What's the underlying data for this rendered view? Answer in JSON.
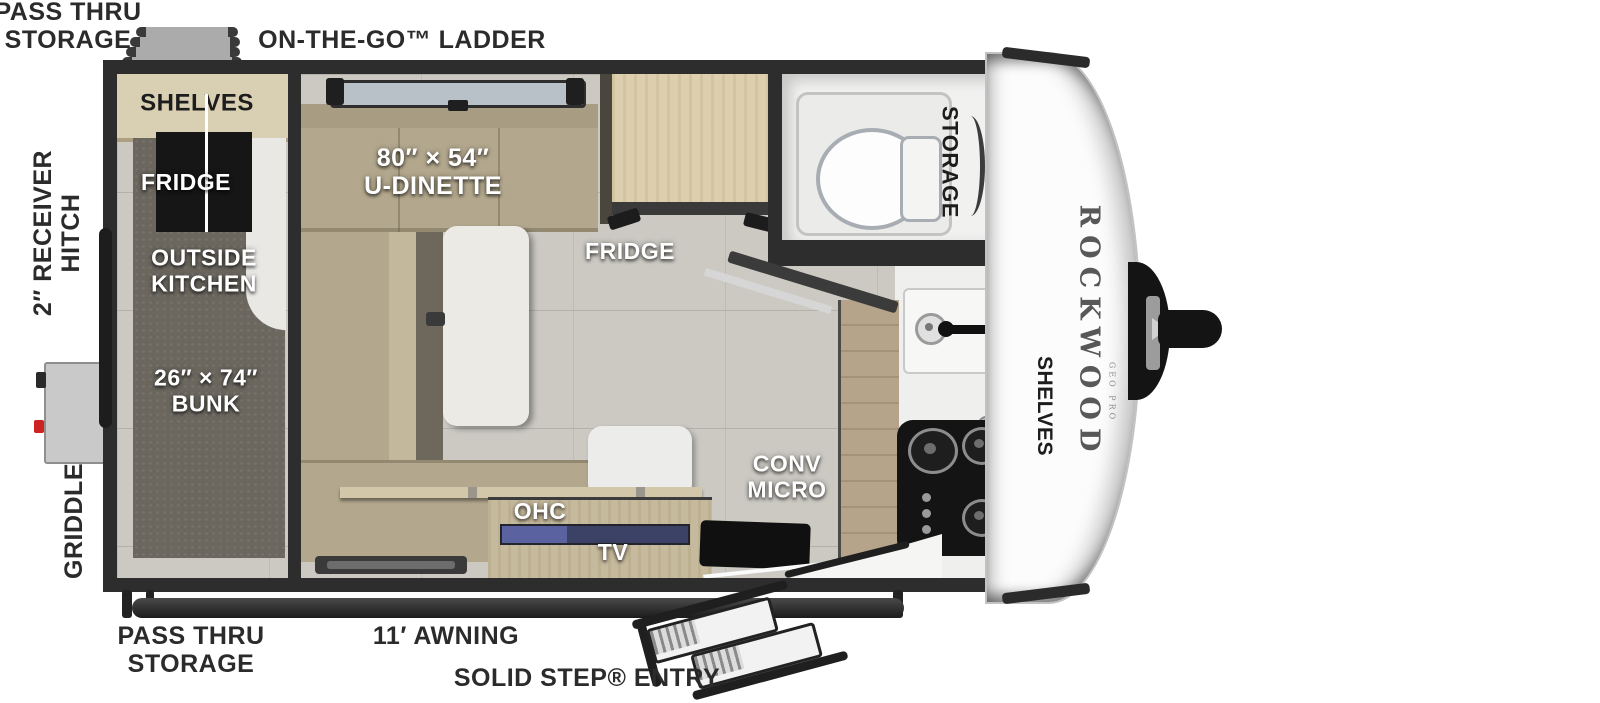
{
  "title": "Rockwood Geo Pro travel trailer floorplan",
  "colors": {
    "wall": "#2d2d2d",
    "floor": "#cbc9c2",
    "cushion": "#b3a88e",
    "wood_cabinet": "#ddcfae",
    "bunk_carpet": "#6b675f",
    "tv_screen": "#3c4266",
    "cooktop": "#141414",
    "label_white": "#ffffff",
    "label_dark": "#2b2b2b",
    "griddle_accent": "#cc2222"
  },
  "labels": {
    "top": {
      "pass_thru_1": "PASS THRU",
      "pass_thru_2": "STORAGE",
      "ladder": "ON-THE-GO™ LADDER"
    },
    "left": {
      "hitch_1": "2″ RECEIVER",
      "hitch_2": "HITCH",
      "griddle": "GRIDDLE"
    },
    "bottom": {
      "pass_thru_1": "PASS THRU",
      "pass_thru_2": "STORAGE",
      "awning": "11′ AWNING",
      "entry": "SOLID STEP® ENTRY"
    },
    "bunk_room": {
      "shelves": "SHELVES",
      "fridge": "FRIDGE",
      "outside_1": "OUTSIDE",
      "outside_2": "KITCHEN",
      "bunk_1": "26″ × 74″",
      "bunk_2": "BUNK"
    },
    "dinette": {
      "size": "80″ × 54″",
      "name": "U-DINETTE"
    },
    "kitchen": {
      "fridge": "FRIDGE",
      "conv_1": "CONV",
      "conv_2": "MICRO",
      "ohc": "OHC",
      "tv": "TV",
      "shelves": "SHELVES"
    },
    "bathroom": {
      "storage": "STORAGE"
    },
    "front_cap": {
      "brand": "ROCKWOOD",
      "model": "GEO PRO"
    }
  }
}
